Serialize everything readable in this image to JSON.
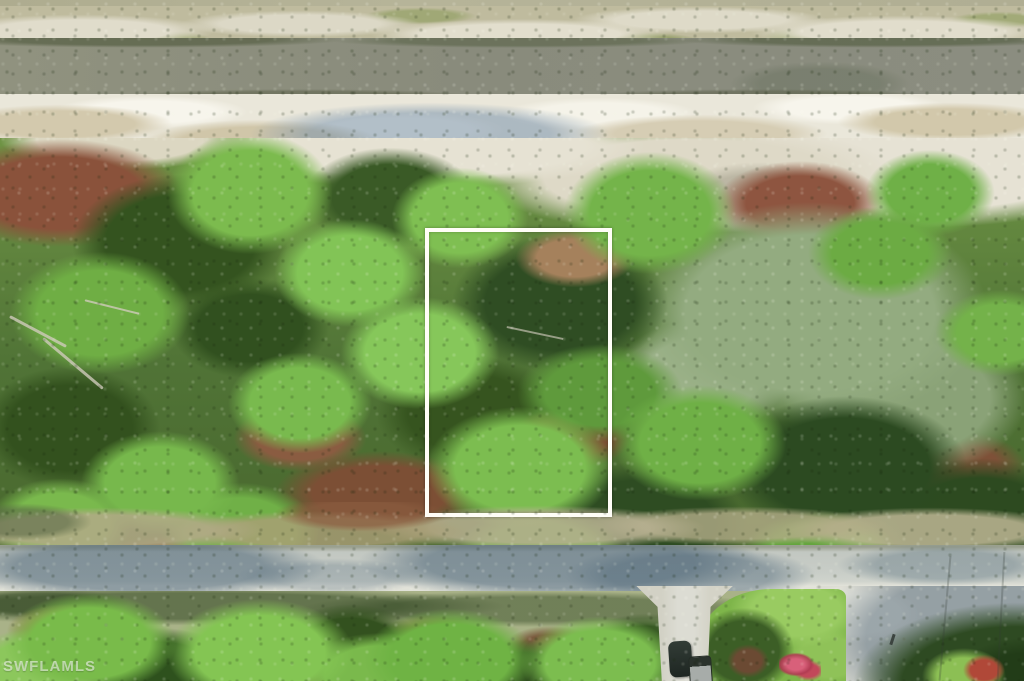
{
  "image": {
    "kind": "aerial-drone-photo",
    "description": "Aerial view of a vacant wooded residential lot outlined in white, bordered by a drainage canal at top and a paved street with a driveway, lawn and parked vehicles at bottom",
    "watermark": "SWFLAMLS"
  },
  "colors": {
    "boundary_outline": "#fffef7",
    "canal_water": "#8c8e7e",
    "bank_sand": "#eae7da",
    "canopy_bright_green": "#7cbb4e",
    "canopy_dark_green": "#2f4d23",
    "canopy_sage": "#93ab80",
    "scrub_brown": "#84503a",
    "road_asphalt": "#c8cdc7",
    "road_shadow": "#56697d",
    "lawn_green": "#7eb54a",
    "driveway_gravel": "#dcdcd3",
    "flower_shrub_pink": "#c2485a",
    "vehicle_dark": "#1e2622",
    "vehicle_bed_gray": "#a7aca9"
  }
}
